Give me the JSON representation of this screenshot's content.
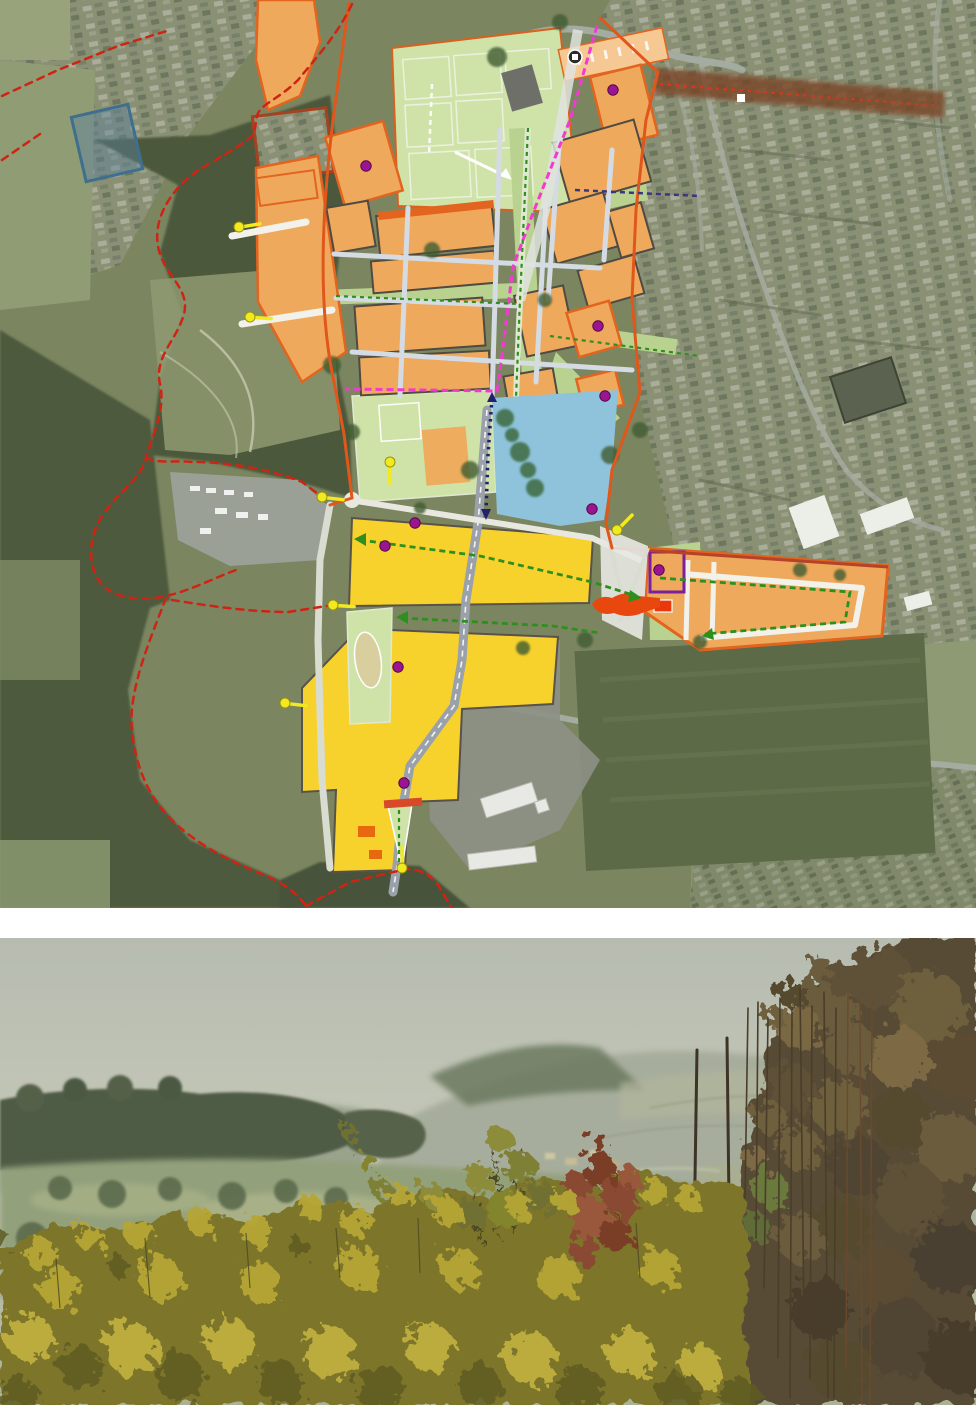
{
  "page": {
    "background": "#ffffff",
    "divider_color": "#ffffff"
  },
  "figures": {
    "masterplan_map": {
      "name": "masterplan-aerial-map",
      "type": "aerial-photo-with-masterplan-overlay",
      "palette": {
        "residential_parcel": "#efa95c",
        "parcel_border": "#e2641f",
        "parcel_edge_dark": "#4f4a42",
        "employment_area": "#f8d22c",
        "playing_fields": "#cfe3a9",
        "green_corridor": "#b9d290",
        "water_body": "#8fc3db",
        "site_boundary_dashed": "#cf2413",
        "site_edge_solid": "#e0571c",
        "primary_route_pink": "#f23ad0",
        "green_route": "#2e8f1f",
        "navy_route": "#23206e",
        "access_marker_yellow": "#f2ea1e",
        "node_dot_purple": "#9c1490",
        "link_band_brown": "#7a4526",
        "road_light": "#d4dbe2",
        "road_grey": "#9aa1ab"
      },
      "markers": {
        "purple_dots": [
          [
            366,
            166
          ],
          [
            613,
            90
          ],
          [
            598,
            326
          ],
          [
            605,
            396
          ],
          [
            415,
            523
          ],
          [
            385,
            546
          ],
          [
            592,
            509
          ],
          [
            398,
            667
          ],
          [
            404,
            783
          ],
          [
            659,
            570
          ]
        ],
        "yellow_access_arrows": [
          [
            239,
            227,
            -28
          ],
          [
            250,
            317,
            -15
          ],
          [
            322,
            497,
            -12
          ],
          [
            333,
            605,
            -15
          ],
          [
            285,
            703,
            -12
          ],
          [
            402,
            868,
            -109
          ],
          [
            617,
            530,
            -64
          ],
          [
            390,
            462,
            71
          ]
        ]
      }
    },
    "landscape_photo": {
      "name": "countryside-view-photo",
      "palette": {
        "sky_haze": "#bcc1b4",
        "distant_hill": "#a7ad9c",
        "woodland_dark": "#4f5b44",
        "valley_fields": "#93a07c",
        "hedge_foliage_yellow": "#b3a433",
        "hedge_foliage_dark": "#5f5c24",
        "autumn_tree_brown": "#6b5c3c",
        "red_bush": "#8a4a30",
        "pole_brown": "#3d3426"
      }
    }
  }
}
